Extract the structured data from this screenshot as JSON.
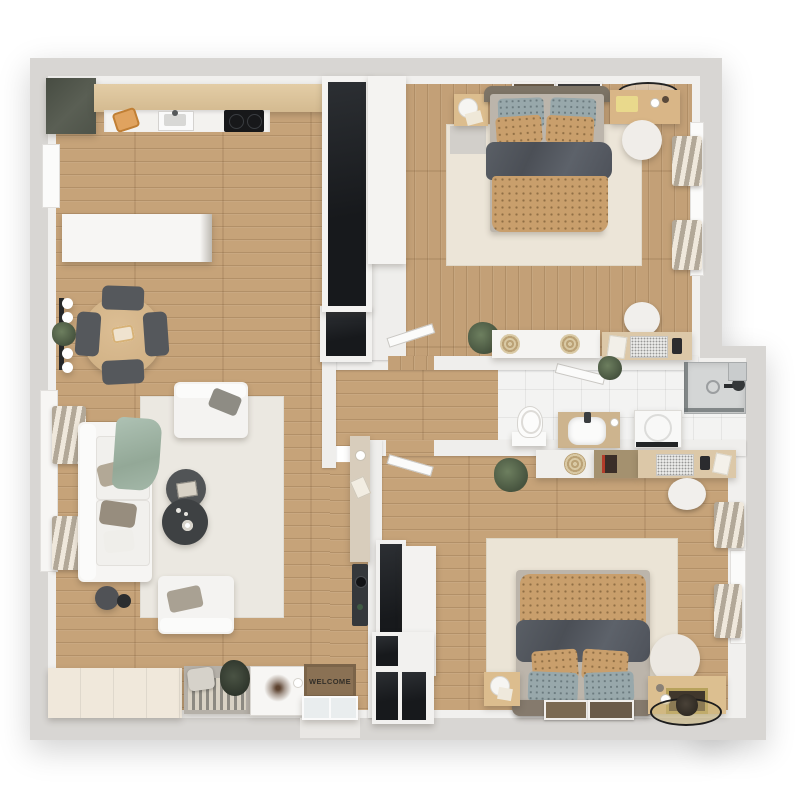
{
  "scene": {
    "type": "3d-floor-plan-top-down",
    "description": "Two-bedroom apartment 3D floor plan render, top view, wood floors and white walls"
  },
  "entry": {
    "welcome_mat_text": "WELCOME"
  },
  "palette": {
    "floor_wood": "#c6a379",
    "bathroom_tile": "#f3f3f2",
    "outer_wall_gray": "#d8d6d3",
    "inner_wall_white": "#efeeec",
    "kitchen_cabinet_olive": "#565b50",
    "counter_wood": "#dcc49c",
    "wardrobe_black": "#1f2226",
    "duvet_dark_gray": "#54585f",
    "blanket_tan": "#c99f6c",
    "pillow_teal": "#98a8ab",
    "rug_cream": "#ebe4d6",
    "sofa_white": "#f6f5f3",
    "coffee_table_dark": "#46494c",
    "radiator_beige": "#cfc5b5",
    "welcome_mat_brown": "#8a7154",
    "plant_green": "#5d6e55",
    "gold_decor": "#b7a25c"
  },
  "rooms": [
    {
      "id": "living-kitchen",
      "furniture": [
        "kitchen corner cabinet",
        "kitchen counter",
        "cutting board",
        "kitchen sink",
        "cooktop",
        "tall black wardrobe",
        "white cabinet",
        "tv sideboard",
        "round dining table",
        "dining chairs x4",
        "wall lamp with plant",
        "left windows",
        "radiators x2",
        "sofa with pillows",
        "sage throw blanket",
        "cream area rug",
        "armchairs x2",
        "round coffee tables x2",
        "floor lamp",
        "wall shelf",
        "intercom panel",
        "dark wall niche"
      ]
    },
    {
      "id": "entry",
      "furniture": [
        "storage platform",
        "slatted bench with pillow",
        "decor art board",
        "welcome mat",
        "open glass entry door",
        "black entry closet"
      ]
    },
    {
      "id": "hallway",
      "furniture": [
        "door to bedroom 1",
        "door to bedroom 2",
        "potted plant"
      ]
    },
    {
      "id": "bedroom-1",
      "furniture": [
        "double bed tan and gray",
        "nightstand with lamp",
        "picture frames x2",
        "vanity desk with round mirror",
        "round stool",
        "radiators x2",
        "right window",
        "white sideboard with jute decor",
        "work desk with laptop",
        "office chair",
        "gray mat",
        "area rug"
      ]
    },
    {
      "id": "bathroom",
      "furniture": [
        "toilet",
        "wood vanity with sink",
        "washing machine",
        "towel rail",
        "shower enclosure with glass",
        "shower head",
        "corner shelf",
        "small plant",
        "entry door blade"
      ]
    },
    {
      "id": "bedroom-2",
      "furniture": [
        "double bed tan and gray",
        "nightstand with lamp",
        "wood console with gold frame",
        "round decor tray with plant",
        "round pouf",
        "picture frames x2",
        "desk with laptop",
        "dark sideboard",
        "white sideboard with jute decor",
        "office chair",
        "potted plant",
        "radiators x2",
        "right window",
        "black wardrobe",
        "white cabinet",
        "area rug"
      ]
    }
  ]
}
